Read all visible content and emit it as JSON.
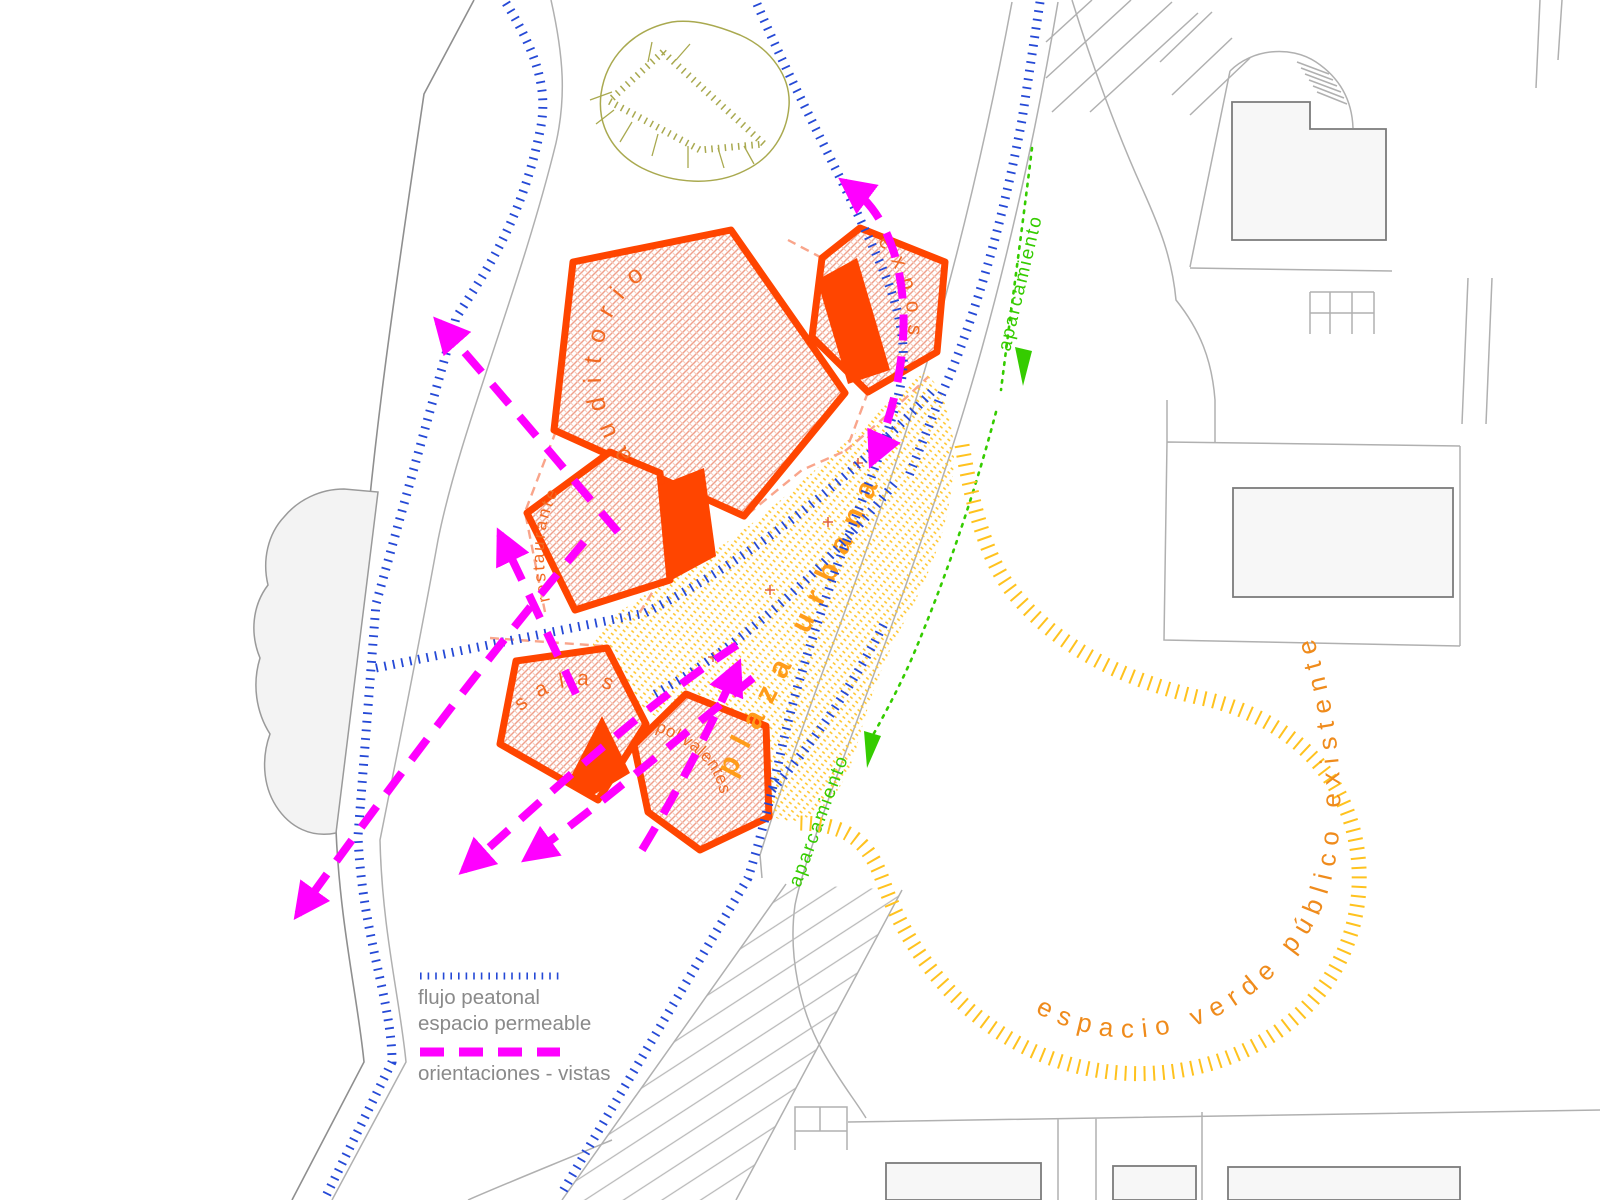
{
  "labels": {
    "auditorium": "auditorio",
    "expo": "expos",
    "restaurant": "restaurante",
    "halls": "salas",
    "multipurpose": "polivalentes",
    "urban_plaza": "plaza urbana",
    "parking_upper": "aparcamiento",
    "parking_lower": "aparcamiento",
    "existing_green": "espacio verde público existente"
  },
  "legend": {
    "pedestrian_flow_line1": "flujo peatonal",
    "pedestrian_flow_line2": "espacio permeable",
    "views_label": "orientaciones - vistas"
  },
  "colors": {
    "building_outline": "#ff4500",
    "building_text": "#f26a22",
    "plaza_hatch": "#ffc429",
    "plaza_text": "#ff9c1a",
    "pedestrian_flow_blue": "#2549d6",
    "views_magenta": "#ff00ff",
    "parking_green": "#35cc00",
    "green_ring_yellow": "#ffc21e",
    "green_ring_text": "#ef8b1c",
    "terrain_olive": "#a9a94f",
    "context_gray": "#b0b0b0"
  }
}
